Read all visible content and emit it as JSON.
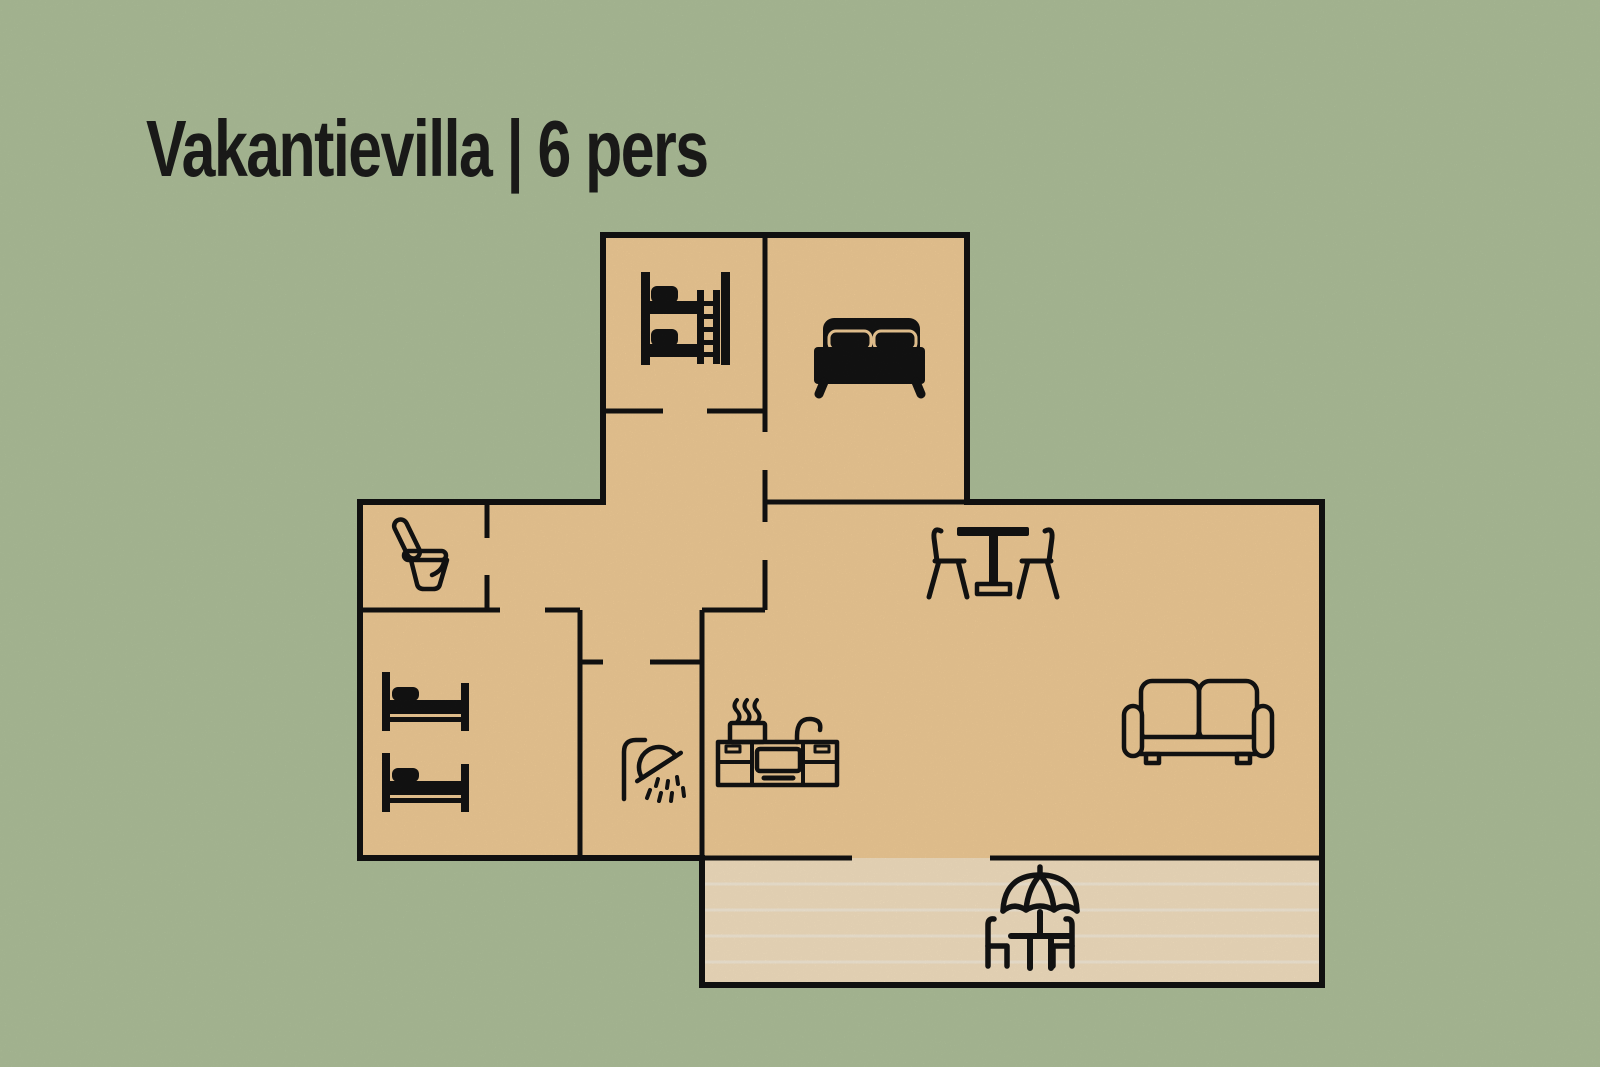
{
  "page": {
    "title": "Vakantievilla | 6 pers"
  },
  "floorplan": {
    "capacity_persons": 6,
    "rooms": [
      {
        "name": "bunk-bedroom",
        "furniture": [
          "bunk bed"
        ]
      },
      {
        "name": "double-bedroom",
        "furniture": [
          "double bed"
        ]
      },
      {
        "name": "toilet-room",
        "furniture": [
          "toilet"
        ]
      },
      {
        "name": "twin-bedroom",
        "furniture": [
          "single bed",
          "single bed"
        ]
      },
      {
        "name": "shower-room",
        "furniture": [
          "shower"
        ]
      },
      {
        "name": "living-kitchen",
        "furniture": [
          "dining table with two chairs",
          "kitchen unit with stove and sink",
          "sofa"
        ]
      },
      {
        "name": "terrace",
        "furniture": [
          "parasol with table and two chairs"
        ]
      }
    ]
  },
  "colors": {
    "background": "#b4c69f",
    "floor": "#f8d29b",
    "terrace": "#fbe7c6",
    "deck_stripe": "#fdf3e2",
    "wall": "#121212",
    "icon": "#141414",
    "title_text": "#1d1d1b"
  }
}
